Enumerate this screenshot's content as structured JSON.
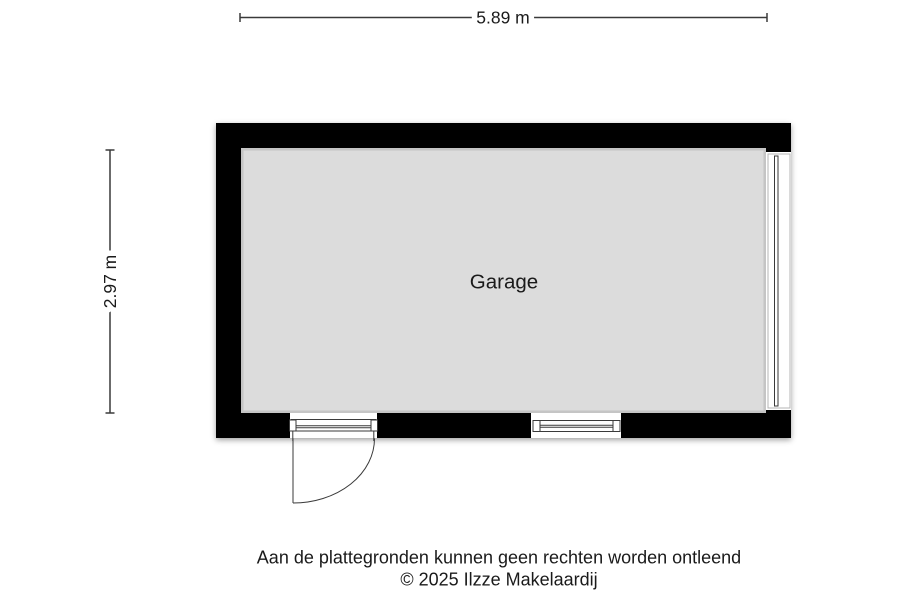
{
  "dimensions": {
    "width_label": "5.89 m",
    "height_label": "2.97 m"
  },
  "room": {
    "label": "Garage"
  },
  "footer": {
    "disclaimer": "Aan de plattegronden kunnen geen rechten worden ontleend",
    "copyright": "© 2025 Ilzze Makelaardij"
  },
  "colors": {
    "wall": "#000000",
    "floor": "#dcdcdc",
    "line": "#3a3a3a",
    "frame_light": "#b4b4b4",
    "background": "#ffffff",
    "text": "#1a1a1a"
  }
}
